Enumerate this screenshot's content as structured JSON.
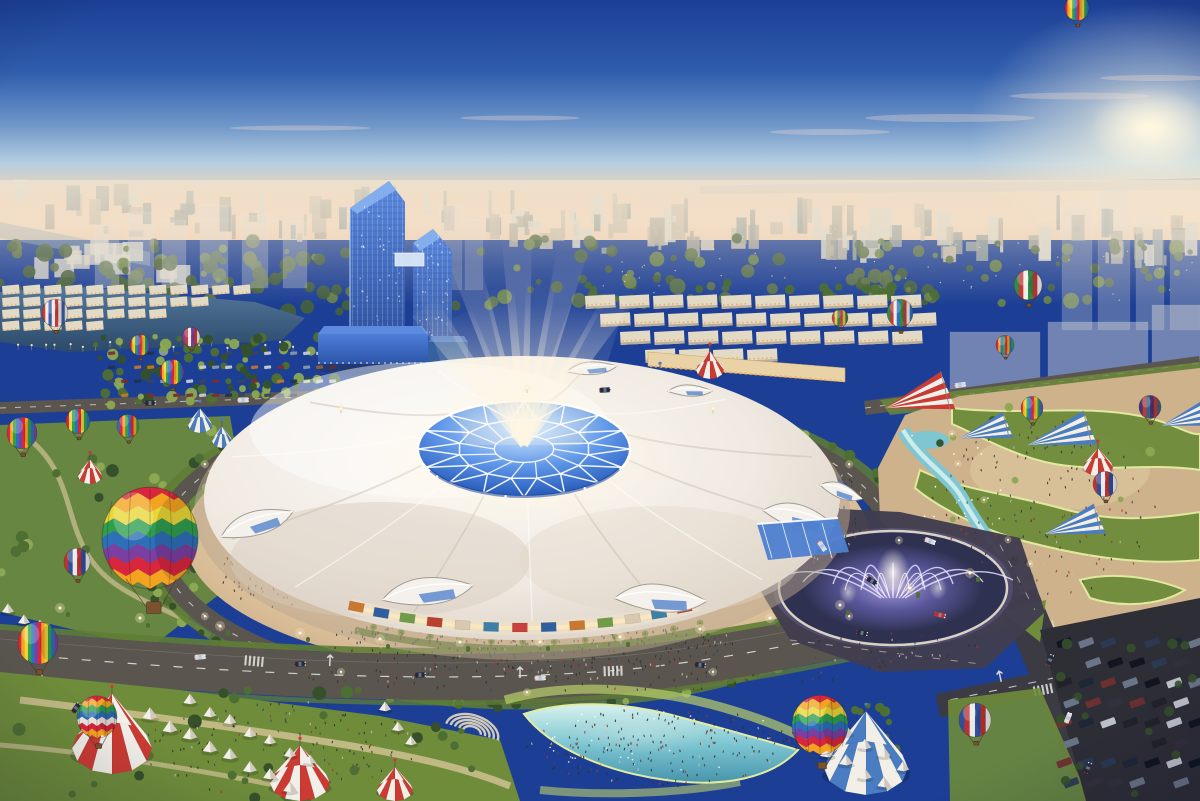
{
  "meta": {
    "title": "Aerial dusk rendering of an expo dome complex",
    "description": "Aerial architectural rendering at dusk: a giant white canopy exhibition dome with a glowing blue geodesic crystal crown and light beams, ringed by a warm plaza and circular road, flanked by twin leaning blue glass towers, a lake, townhouse districts, a musical fountain roundabout, cyan leisure pools, festival tents, striped big-top tents, parking lots and many colorful hot air balloons, with a hazy city skyline and pink sunset horizon."
  },
  "palette": {
    "sky_top": "#1C3F95",
    "sky_mid": "#2F5DAD",
    "sky_steel": "#6F96C9",
    "sky_pale": "#B6CFE0",
    "horizon_pink": "#EFD2B6",
    "horizon_cream": "#F4D9BF",
    "sun_glow": "#FFF7E0",
    "cloud_pink": "#F6DDD0",
    "hills": "#9AA8B8",
    "city_bldg_a": "#C9C0AE",
    "city_bldg_b": "#B2ADA0",
    "city_bldg_c": "#DCD8CC",
    "city_bldg_d": "#9AA5A0",
    "city_green": "#5C7247",
    "city_green_dark": "#46603A",
    "city_window": "#FFD9A0",
    "haze": "#F2E6D2",
    "river": "#8FA8B8",
    "lake_light": "#54789C",
    "lake_deep": "#2C4A6A",
    "shore_light": "#FFE9B8",
    "house_wall": "#E3DAC6",
    "house_shadow": "#B8AE9C",
    "window_warm": "#F0A85A",
    "retail_wall": "#E9D2A6",
    "retail_light": "#F7B35C",
    "ghost": "#E6E2DA",
    "tower_top": "#5E8CE2",
    "tower_bottom": "#2A4C9A",
    "tower_roof": "#86B0EE",
    "tower_edge": "#BFD9F8",
    "podium_top": "#4E7ED8",
    "podium_bottom": "#2B55A8",
    "dome_top": "#FCFAF6",
    "dome_mid": "#F0EAE2",
    "dome_shadow": "#D6CABD",
    "dome_fold": "#C9BEB1",
    "facade_wall": "#EADFCB",
    "facade_glow": "#FFE9B8",
    "crown_ice": "#DDF0FF",
    "crown_blue": "#5E96E8",
    "crown_deep": "#2558B8",
    "crown_navy": "#1B3F8E",
    "beam": "#FFF6E2",
    "plaza_center": "#EFD9AF",
    "plaza_mid": "#DCC29C",
    "plaza_edge": "#C3A27E",
    "colonnade": "#EFE8DC",
    "ring_green": "#5F7D35",
    "palm_green": "#7E9C3F",
    "palm_trunk": "#6B4A2E",
    "tree_dark": "#35502B",
    "tree_mid": "#4E6F33",
    "tree_lit": "#8CA852",
    "lawn": "#6E8C3A",
    "lawn_lit": "#B9CF6A",
    "lawn_glow": "#E2ECA0",
    "sand": "#CDB28C",
    "sand_lit": "#E2CCA4",
    "pool_glow": "#D8F2EE",
    "pool": "#7EC6D2",
    "pool_deep": "#4795AC",
    "road": "#5A564F",
    "road_dark": "#3C3A42",
    "road_darker": "#2E2E36",
    "marking": "#E8E6E0",
    "asphalt_purple": "#413D4E",
    "fountain_rim": "#D8D2C4",
    "fountain_basin": "#2E3150",
    "fountain_jet": "#E6DFFF",
    "fountain_glow": "#8F7FDC",
    "tent_white": "#F2EFE8",
    "tent_shade": "#CFC9BD",
    "tent_red": "#CB3A33",
    "tent_blue": "#4A7CC2",
    "car_dark": "#232A3A",
    "light_warm": "#FFE9B8",
    "crowd_dark": "#3A3028",
    "vignette": "#0A0F2D"
  },
  "scene": {
    "sun": {
      "x": 1150,
      "y": 128
    },
    "clouds": [
      [
        950,
        118,
        85,
        4
      ],
      [
        1080,
        96,
        70,
        3.5
      ],
      [
        1155,
        78,
        55,
        3
      ],
      [
        830,
        132,
        60,
        3
      ],
      [
        300,
        128,
        70,
        2.5
      ],
      [
        520,
        118,
        60,
        2.5
      ]
    ],
    "beams": [
      [
        -36,
        170
      ],
      [
        -27,
        145
      ],
      [
        -18,
        190
      ],
      [
        -9,
        158
      ],
      [
        -2,
        205
      ],
      [
        6,
        162
      ],
      [
        14,
        196
      ],
      [
        24,
        150
      ],
      [
        33,
        175
      ]
    ],
    "facade_panels": [
      "#B8412F",
      "#3E7FA8",
      "#D8C8B0",
      "#6E9C48",
      "#C87830",
      "#2F5FA0",
      "#C84040",
      "#3E7FA8",
      "#D8C8B0",
      "#B8412F",
      "#6E9C48",
      "#2F5FA0",
      "#C87830"
    ],
    "banners": [
      [
        824,
        470
      ],
      [
        833,
        492
      ],
      [
        843,
        512
      ],
      [
        853,
        530
      ],
      [
        748,
        441
      ],
      [
        336,
        586
      ],
      [
        362,
        600
      ],
      [
        607,
        562
      ],
      [
        700,
        580
      ]
    ],
    "balloons": [
      {
        "x": 55,
        "y": 313,
        "r": 13,
        "type": "stripes",
        "colors": [
          "#C23B3B",
          "#EDE8E0",
          "#3A5CA8",
          "#EDE8E0"
        ]
      },
      {
        "x": 140,
        "y": 345,
        "r": 10,
        "type": "stripes",
        "colors": [
          "#D7263D",
          "#F4A321",
          "#EAD637",
          "#2E9E4F",
          "#2D6FB8",
          "#7A3FA0"
        ]
      },
      {
        "x": 191,
        "y": 337,
        "r": 9,
        "type": "stripes",
        "colors": [
          "#7A3FA0",
          "#C23B3B",
          "#EDE8E0"
        ]
      },
      {
        "x": 172,
        "y": 372,
        "r": 12,
        "type": "stripes",
        "colors": [
          "#D7263D",
          "#F4A321",
          "#EAD637",
          "#2E9E4F",
          "#2D6FB8",
          "#7A3FA0"
        ]
      },
      {
        "x": 22,
        "y": 433,
        "r": 15,
        "type": "stripes",
        "colors": [
          "#D7263D",
          "#F4A321",
          "#2E9E4F",
          "#2D6FB8",
          "#7A3FA0"
        ]
      },
      {
        "x": 78,
        "y": 421,
        "r": 12,
        "type": "stripes",
        "colors": [
          "#D7263D",
          "#EAD637",
          "#2E9E4F",
          "#2D6FB8"
        ]
      },
      {
        "x": 128,
        "y": 426,
        "r": 11,
        "type": "stripes",
        "colors": [
          "#2D6FB8",
          "#D7263D",
          "#F4A321",
          "#2E9E4F"
        ]
      },
      {
        "x": 150,
        "y": 538,
        "r": 48,
        "type": "chevron",
        "colors": [
          "#D7263D",
          "#F4A321",
          "#EAD637",
          "#2E9E4F",
          "#2D6FB8",
          "#7A3FA0"
        ]
      },
      {
        "x": 77,
        "y": 562,
        "r": 13,
        "type": "stripes",
        "colors": [
          "#B83434",
          "#2F4F9E",
          "#E8E8E8"
        ]
      },
      {
        "x": 38,
        "y": 643,
        "r": 20,
        "type": "stripes",
        "colors": [
          "#D7263D",
          "#F4A321",
          "#EAD637",
          "#2E9E4F",
          "#2D6FB8",
          "#7A3FA0"
        ]
      },
      {
        "x": 97,
        "y": 717,
        "r": 20,
        "type": "chevron",
        "colors": [
          "#D7263D",
          "#F4A321",
          "#2E9E4F",
          "#2D6FB8",
          "#EDE8E0"
        ]
      },
      {
        "x": 840,
        "y": 318,
        "r": 8,
        "type": "stripes",
        "colors": [
          "#B84848",
          "#E3C44E",
          "#3F7A44"
        ]
      },
      {
        "x": 900,
        "y": 313,
        "r": 13,
        "type": "stripes",
        "colors": [
          "#2E8C46",
          "#C23B3B",
          "#EDE8E0",
          "#2D6FB8"
        ]
      },
      {
        "x": 1028,
        "y": 285,
        "r": 14,
        "type": "stripes",
        "colors": [
          "#2E8C46",
          "#C23B3B",
          "#F2EEE6"
        ]
      },
      {
        "x": 1005,
        "y": 345,
        "r": 9,
        "type": "stripes",
        "colors": [
          "#D7263D",
          "#F4A321",
          "#2D6FB8",
          "#2E9E4F"
        ]
      },
      {
        "x": 1077,
        "y": 8,
        "r": 12,
        "type": "stripes",
        "colors": [
          "#D7263D",
          "#F4A321",
          "#EAD637",
          "#2E9E4F",
          "#2D6FB8"
        ]
      },
      {
        "x": 1032,
        "y": 408,
        "r": 11,
        "type": "stripes",
        "colors": [
          "#D7263D",
          "#F4A321",
          "#EAD637",
          "#2E9E4F",
          "#2D6FB8",
          "#7A3FA0"
        ]
      },
      {
        "x": 1150,
        "y": 407,
        "r": 11,
        "type": "stripes",
        "colors": [
          "#4A3070",
          "#B83A3A",
          "#3A6080"
        ]
      },
      {
        "x": 1105,
        "y": 484,
        "r": 12,
        "type": "stripes",
        "colors": [
          "#B83434",
          "#2F4F9E",
          "#E8E8E8"
        ]
      },
      {
        "x": 820,
        "y": 725,
        "r": 28,
        "type": "chevron",
        "colors": [
          "#D7263D",
          "#F4A321",
          "#EAD637",
          "#2E9E4F",
          "#2D6FB8",
          "#7A3FA0"
        ]
      },
      {
        "x": 975,
        "y": 720,
        "r": 16,
        "type": "stripes",
        "colors": [
          "#2F4F9E",
          "#B83434",
          "#E8E8E8"
        ]
      }
    ],
    "striped_tents": [
      {
        "x": 112,
        "y": 748,
        "rx": 40,
        "ry": 26,
        "color": "red",
        "type": "bigtop"
      },
      {
        "x": 300,
        "y": 783,
        "rx": 30,
        "ry": 18,
        "color": "red",
        "type": "bigtop"
      },
      {
        "x": 395,
        "y": 790,
        "rx": 18,
        "ry": 11,
        "color": "red",
        "type": "bigtop"
      },
      {
        "x": 90,
        "y": 476,
        "rx": 12,
        "ry": 8,
        "color": "red",
        "type": "bigtop"
      },
      {
        "x": 710,
        "y": 370,
        "rx": 14,
        "ry": 9,
        "color": "red",
        "type": "bigtop"
      },
      {
        "x": 918,
        "y": 400,
        "rx": 34,
        "ry": 20,
        "color": "red",
        "type": "kite"
      },
      {
        "x": 1098,
        "y": 467,
        "rx": 15,
        "ry": 9,
        "color": "red",
        "type": "bigtop"
      },
      {
        "x": 866,
        "y": 768,
        "rx": 42,
        "ry": 27,
        "color": "blue",
        "type": "bigtop"
      },
      {
        "x": 337,
        "y": 430,
        "rx": 17,
        "ry": 10,
        "color": "blue",
        "type": "bigtop"
      },
      {
        "x": 200,
        "y": 425,
        "rx": 12,
        "ry": 8,
        "color": "blue",
        "type": "bigtop"
      },
      {
        "x": 222,
        "y": 441,
        "rx": 10,
        "ry": 7,
        "color": "blue",
        "type": "bigtop"
      },
      {
        "x": 660,
        "y": 385,
        "rx": 11,
        "ry": 7,
        "color": "blue",
        "type": "bigtop"
      },
      {
        "x": 985,
        "y": 432,
        "rx": 26,
        "ry": 14,
        "color": "blue",
        "type": "kite"
      },
      {
        "x": 1060,
        "y": 437,
        "rx": 34,
        "ry": 18,
        "color": "blue",
        "type": "kite"
      },
      {
        "x": 1073,
        "y": 527,
        "rx": 30,
        "ry": 16,
        "color": "blue",
        "type": "kite"
      },
      {
        "x": 1185,
        "y": 420,
        "rx": 24,
        "ry": 13,
        "color": "blue",
        "type": "kite"
      }
    ],
    "tent_rows": [
      {
        "x": 150,
        "y": 718,
        "n": 8,
        "dx": 20,
        "dy": 10,
        "s": 15
      },
      {
        "x": 190,
        "y": 703,
        "n": 7,
        "dx": 20,
        "dy": 10,
        "s": 13
      },
      {
        "x": 808,
        "y": 742,
        "n": 5,
        "dx": 19,
        "dy": 11,
        "s": 14
      },
      {
        "x": 846,
        "y": 734,
        "n": 4,
        "dx": 19,
        "dy": 11,
        "s": 13
      },
      {
        "x": 8,
        "y": 612,
        "n": 3,
        "dx": 16,
        "dy": 8,
        "s": 12
      },
      {
        "x": 385,
        "y": 710,
        "n": 3,
        "dx": 13,
        "dy": 17,
        "s": 12
      }
    ],
    "crowds": [
      [
        530,
        642,
        205,
        30,
        340
      ],
      [
        815,
        515,
        55,
        48,
        150
      ],
      [
        280,
        572,
        60,
        34,
        90
      ],
      [
        520,
        408,
        110,
        16,
        70
      ],
      [
        665,
        747,
        140,
        40,
        200
      ],
      [
        1045,
        505,
        115,
        90,
        160
      ],
      [
        280,
        748,
        140,
        48,
        130
      ],
      [
        560,
        676,
        280,
        14,
        90
      ],
      [
        893,
        648,
        90,
        22,
        40
      ],
      [
        480,
        630,
        60,
        22,
        60
      ]
    ],
    "street_cars": [
      [
        300,
        664,
        -4,
        0
      ],
      [
        420,
        675,
        -3,
        0
      ],
      [
        540,
        678,
        -1,
        1
      ],
      [
        700,
        665,
        6,
        0
      ],
      [
        862,
        633,
        12,
        0
      ],
      [
        940,
        615,
        14,
        2
      ],
      [
        1050,
        660,
        -66,
        0
      ],
      [
        1068,
        718,
        -68,
        1
      ],
      [
        1088,
        768,
        -68,
        0
      ],
      [
        200,
        657,
        -5,
        1
      ],
      [
        150,
        403,
        -2,
        0
      ],
      [
        243,
        400,
        -2,
        1
      ],
      [
        76,
        708,
        -55,
        0
      ],
      [
        872,
        581,
        30,
        0
      ],
      [
        822,
        546,
        55,
        1
      ],
      [
        930,
        541,
        20,
        1
      ],
      [
        605,
        390,
        -3,
        0
      ],
      [
        960,
        385,
        -8,
        1
      ]
    ],
    "lights_blvd": [
      [
        60,
        640
      ],
      [
        140,
        650
      ],
      [
        220,
        658
      ],
      [
        300,
        665
      ],
      [
        380,
        671
      ],
      [
        460,
        674
      ],
      [
        540,
        674
      ],
      [
        620,
        669
      ],
      [
        700,
        661
      ],
      [
        770,
        650
      ],
      [
        840,
        637
      ],
      [
        910,
        620
      ],
      [
        970,
        605
      ]
    ],
    "ring_light_angles": [
      0,
      30,
      60,
      90,
      120,
      150,
      180,
      210,
      240,
      270,
      300,
      330
    ],
    "park_lights": [
      [
        958,
        468
      ],
      [
        984,
        504
      ],
      [
        1008,
        544
      ],
      [
        952,
        438
      ],
      [
        1030,
        568
      ]
    ],
    "counts": {
      "skyline": 150,
      "sky_greens": 150,
      "sky_windows": 70,
      "treepark": 90,
      "ring_trees": 64
    }
  }
}
